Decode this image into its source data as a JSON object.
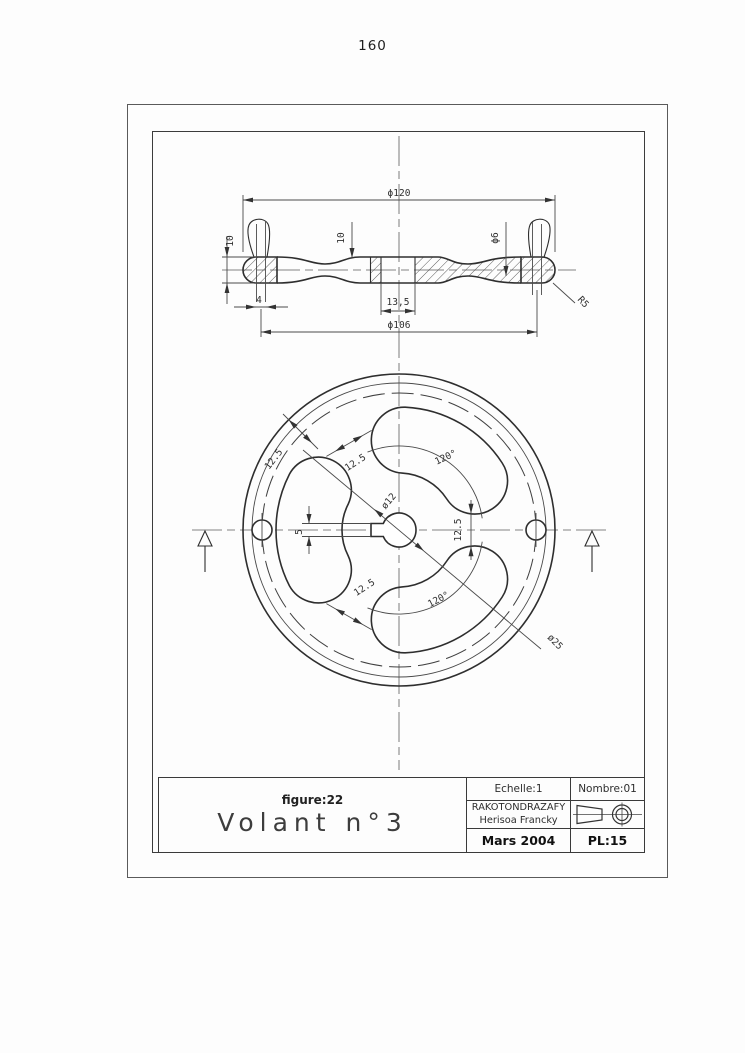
{
  "page": {
    "number": "160"
  },
  "drawing": {
    "section_view": {
      "dim_outer_diameter": "ϕ120",
      "dim_rim_thickness": "10",
      "dim_web_step": "10",
      "dim_hole_diameter": "ϕ6",
      "dim_handle_shank_width": "4",
      "dim_hub_length": "13,5",
      "dim_handle_circle_diameter": "ϕ106",
      "dim_fillet_radius": "R5"
    },
    "front_view": {
      "dim_rim_width": "12.5",
      "dim_spoke_width_upper": "12.5",
      "dim_spoke_width_right": "12.5",
      "dim_spoke_width_lower": "12.5",
      "dim_angle_upper": "120°",
      "dim_angle_lower": "120°",
      "dim_hub_bore": "ø12",
      "dim_hub_boss": "ø25",
      "dim_keyway_width": "5"
    }
  },
  "title_block": {
    "figure_label": "figure:22",
    "drawing_title": "Volant n°3",
    "scale": "Echelle:1",
    "quantity": "Nombre:01",
    "author_line1": "RAKOTONDRAZAFY",
    "author_line2": "Herisoa Francky",
    "date": "Mars 2004",
    "plate": "PL:15"
  },
  "colors": {
    "line_main": "#2e2e2e",
    "line_thin": "#4a4a4a",
    "paper": "#ffffff"
  }
}
